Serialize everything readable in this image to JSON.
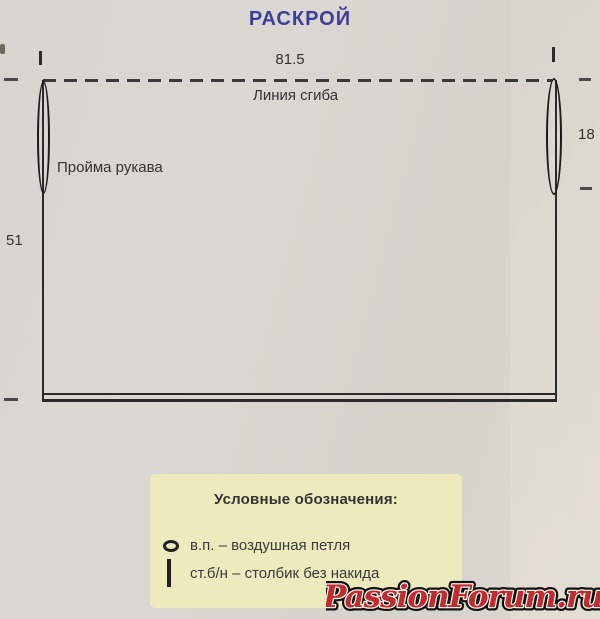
{
  "page": {
    "title": "РАСКРОЙ"
  },
  "diagram": {
    "top_width": "81.5",
    "fold_line": "Линия сгиба",
    "armhole": "Пройма рукава",
    "side_height": "51",
    "armhole_depth": "18"
  },
  "legend": {
    "title": "Условные обозначения:",
    "items": [
      {
        "icon": "chain-stitch-oval",
        "label": "в.п. – воздушная петля"
      },
      {
        "icon": "single-crochet-bar",
        "label": "ст.б/н – столбик без накида"
      }
    ]
  },
  "watermark": {
    "text": "PassionForum.ru"
  },
  "colors": {
    "title": "#3e3e99",
    "diagram_line": "#2a2a2a",
    "legend_bg": "#edebbe",
    "watermark_fill": "#c02a30",
    "paper_bg": "#d8d5d0"
  }
}
